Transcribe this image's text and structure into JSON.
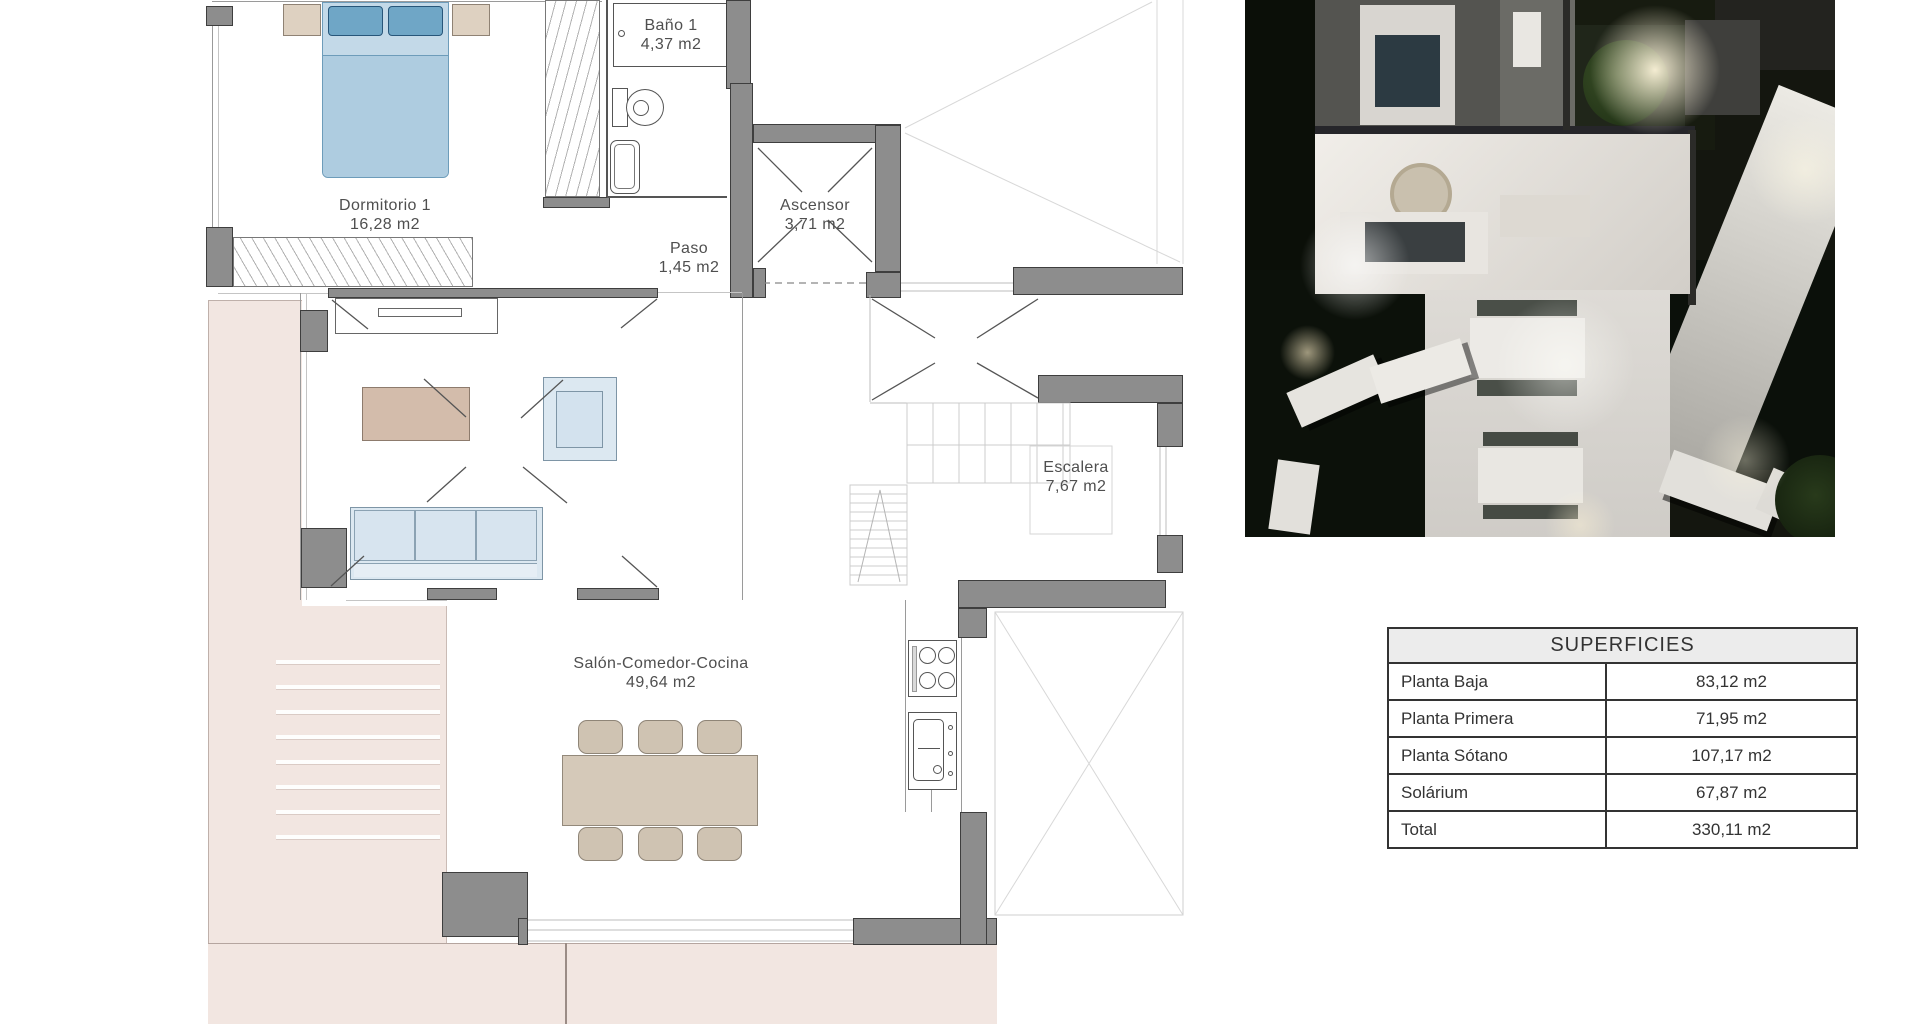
{
  "floor_plan": {
    "rooms": [
      {
        "name": "Dormitorio 1",
        "area": "16,28 m2"
      },
      {
        "name": "Baño 1",
        "area": "4,37 m2"
      },
      {
        "name": "Paso",
        "area": "1,45 m2"
      },
      {
        "name": "Ascensor",
        "area": "3,71 m2"
      },
      {
        "name": "Escalera",
        "area": "7,67 m2"
      },
      {
        "name": "Salón-Comedor-Cocina",
        "area": "49,64 m2"
      }
    ],
    "colors": {
      "wall_gray": "#8d8d8d",
      "terrace_pink": "#f2e6e1",
      "bed_blue": "#aecce0",
      "pillow_blue": "#6fa6c6",
      "sofa_blue": "#dce8f1",
      "rug_beige": "#d3bcab",
      "dining_beige": "#d5c9b9"
    }
  },
  "surfaces_table": {
    "title": "SUPERFICIES",
    "rows": [
      {
        "label": "Planta Baja",
        "value": "83,12 m2"
      },
      {
        "label": "Planta Primera",
        "value": "71,95 m2"
      },
      {
        "label": "Planta Sótano",
        "value": "107,17 m2"
      },
      {
        "label": "Solárium",
        "value": "67,87 m2"
      },
      {
        "label": "Total",
        "value": "330,11 m2"
      }
    ]
  }
}
